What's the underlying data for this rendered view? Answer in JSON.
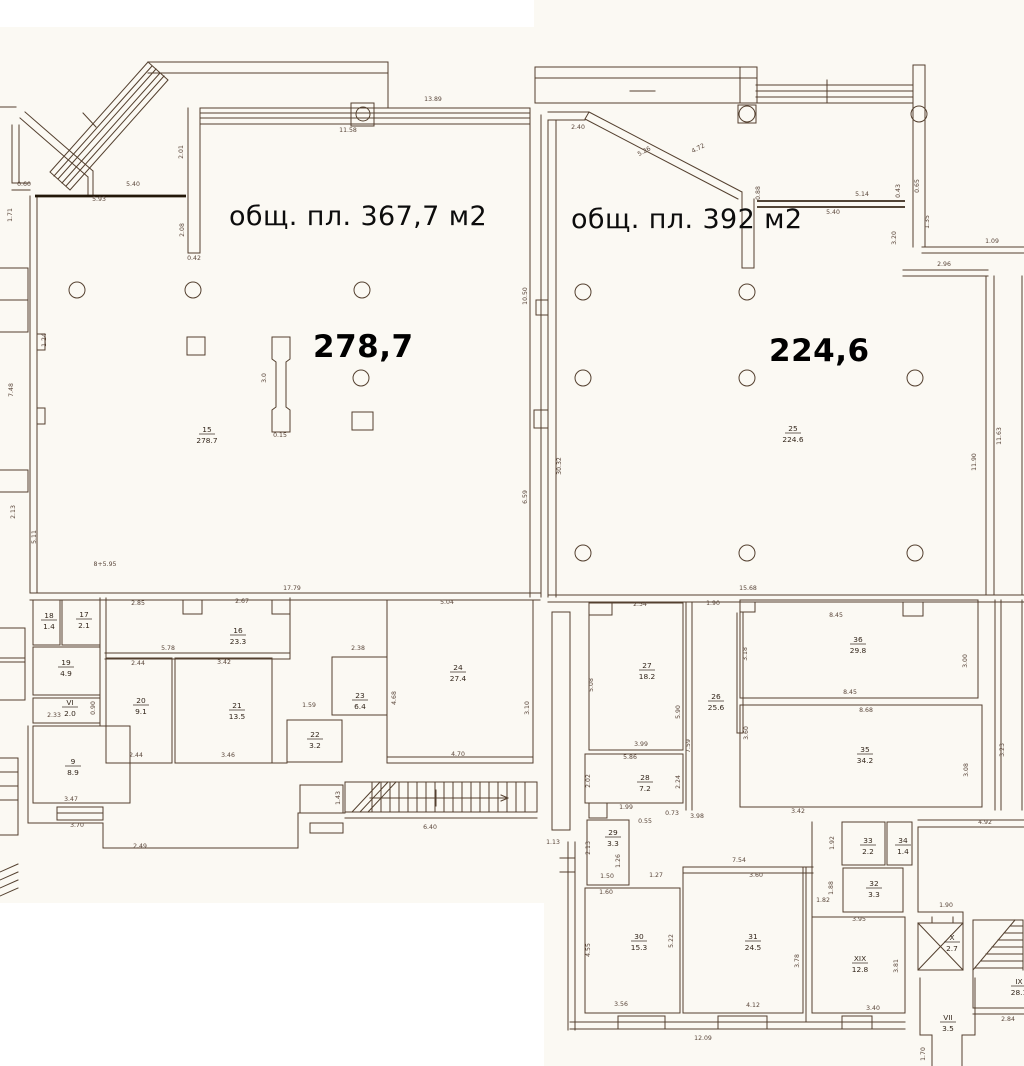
{
  "units": {
    "left": {
      "label": "общ. пл. 367,7 м2",
      "value": "278,7"
    },
    "right": {
      "label": "общ. пл. 392 м2",
      "value": "224,6"
    }
  },
  "colors": {
    "paper": "#fbf9f3",
    "ink": "#54402f",
    "label_ink": "#33261b",
    "dim_ink": "#5a463a",
    "text": "#0c0c0c"
  },
  "rooms": [
    {
      "n": "15",
      "a": "278.7",
      "x": 207,
      "y": 434
    },
    {
      "n": "25",
      "a": "224.6",
      "x": 793,
      "y": 433
    },
    {
      "n": "18",
      "a": "1.4",
      "x": 49,
      "y": 620
    },
    {
      "n": "17",
      "a": "2.1",
      "x": 84,
      "y": 619
    },
    {
      "n": "16",
      "a": "23.3",
      "x": 238,
      "y": 635
    },
    {
      "n": "19",
      "a": "4.9",
      "x": 66,
      "y": 667
    },
    {
      "n": "VI",
      "a": "2.0",
      "x": 70,
      "y": 707
    },
    {
      "n": "9",
      "a": "8.9",
      "x": 73,
      "y": 766
    },
    {
      "n": "20",
      "a": "9.1",
      "x": 141,
      "y": 705
    },
    {
      "n": "21",
      "a": "13.5",
      "x": 237,
      "y": 710
    },
    {
      "n": "22",
      "a": "3.2",
      "x": 315,
      "y": 739
    },
    {
      "n": "23",
      "a": "6.4",
      "x": 360,
      "y": 700
    },
    {
      "n": "24",
      "a": "27.4",
      "x": 458,
      "y": 672
    },
    {
      "n": "27",
      "a": "18.2",
      "x": 647,
      "y": 670
    },
    {
      "n": "26",
      "a": "25.6",
      "x": 716,
      "y": 701
    },
    {
      "n": "28",
      "a": "7.2",
      "x": 645,
      "y": 782
    },
    {
      "n": "36",
      "a": "29.8",
      "x": 858,
      "y": 644
    },
    {
      "n": "35",
      "a": "34.2",
      "x": 865,
      "y": 754
    },
    {
      "n": "29",
      "a": "3.3",
      "x": 613,
      "y": 837
    },
    {
      "n": "30",
      "a": "15.3",
      "x": 639,
      "y": 941
    },
    {
      "n": "31",
      "a": "24.5",
      "x": 753,
      "y": 941
    },
    {
      "n": "33",
      "a": "2.2",
      "x": 868,
      "y": 845
    },
    {
      "n": "34",
      "a": "1.4",
      "x": 903,
      "y": 845
    },
    {
      "n": "32",
      "a": "3.3",
      "x": 874,
      "y": 888
    },
    {
      "n": "XIX",
      "a": "12.8",
      "x": 860,
      "y": 963
    },
    {
      "n": "X",
      "a": "2.7",
      "x": 952,
      "y": 942
    },
    {
      "n": "VII",
      "a": "3.5",
      "x": 948,
      "y": 1022
    },
    {
      "n": "IX",
      "a": "28.1",
      "x": 1019,
      "y": 986
    }
  ],
  "dimensions": [
    {
      "t": "5.40",
      "x": 133,
      "y": 186
    },
    {
      "t": "5.93",
      "x": 99,
      "y": 201
    },
    {
      "t": "0.60",
      "x": 24,
      "y": 186
    },
    {
      "t": "1.71",
      "x": 12,
      "y": 215,
      "r": -90
    },
    {
      "t": "2.01",
      "x": 183,
      "y": 152,
      "r": -90
    },
    {
      "t": "2.08",
      "x": 184,
      "y": 230,
      "r": -90
    },
    {
      "t": "0.42",
      "x": 194,
      "y": 260
    },
    {
      "t": "11.58",
      "x": 348,
      "y": 132
    },
    {
      "t": "13.89",
      "x": 433,
      "y": 101
    },
    {
      "t": "7.48",
      "x": 13,
      "y": 390,
      "r": -90
    },
    {
      "t": "1.24",
      "x": 46,
      "y": 340,
      "r": -90
    },
    {
      "t": "2.13",
      "x": 15,
      "y": 512,
      "r": -90
    },
    {
      "t": "5.11",
      "x": 36,
      "y": 537,
      "r": -90
    },
    {
      "t": "8+5.95",
      "x": 105,
      "y": 566
    },
    {
      "t": "17.79",
      "x": 292,
      "y": 590
    },
    {
      "t": "3.0",
      "x": 266,
      "y": 378,
      "r": -90
    },
    {
      "t": "0.15",
      "x": 280,
      "y": 437
    },
    {
      "t": "6.59",
      "x": 527,
      "y": 497,
      "r": -90
    },
    {
      "t": "10.50",
      "x": 527,
      "y": 296,
      "r": -90
    },
    {
      "t": "30.32",
      "x": 561,
      "y": 466,
      "r": -90
    },
    {
      "t": "2.40",
      "x": 578,
      "y": 129
    },
    {
      "t": "5.26",
      "x": 645,
      "y": 153,
      "r": -28
    },
    {
      "t": "4.72",
      "x": 699,
      "y": 150,
      "r": -28
    },
    {
      "t": "0.88",
      "x": 760,
      "y": 193,
      "r": -90
    },
    {
      "t": "0.43",
      "x": 900,
      "y": 191,
      "r": -90
    },
    {
      "t": "0.65",
      "x": 919,
      "y": 186,
      "r": -90
    },
    {
      "t": "5.14",
      "x": 862,
      "y": 196
    },
    {
      "t": "5.40",
      "x": 833,
      "y": 214
    },
    {
      "t": "1.35",
      "x": 929,
      "y": 222,
      "r": -90
    },
    {
      "t": "3.20",
      "x": 896,
      "y": 238,
      "r": -90
    },
    {
      "t": "1.09",
      "x": 992,
      "y": 243
    },
    {
      "t": "2.96",
      "x": 944,
      "y": 266
    },
    {
      "t": "11.63",
      "x": 1001,
      "y": 436,
      "r": -90
    },
    {
      "t": "11.90",
      "x": 976,
      "y": 462,
      "r": -90
    },
    {
      "t": "15.68",
      "x": 748,
      "y": 590
    },
    {
      "t": "2.85",
      "x": 138,
      "y": 605
    },
    {
      "t": "2.67",
      "x": 242,
      "y": 603
    },
    {
      "t": "5.78",
      "x": 168,
      "y": 650
    },
    {
      "t": "2.44",
      "x": 138,
      "y": 665
    },
    {
      "t": "3.42",
      "x": 224,
      "y": 664
    },
    {
      "t": "2.44",
      "x": 136,
      "y": 757
    },
    {
      "t": "3.46",
      "x": 228,
      "y": 757
    },
    {
      "t": "2.33",
      "x": 54,
      "y": 717
    },
    {
      "t": "0.90",
      "x": 95,
      "y": 708,
      "r": -90
    },
    {
      "t": "1.59",
      "x": 309,
      "y": 707
    },
    {
      "t": "2.38",
      "x": 358,
      "y": 650
    },
    {
      "t": "5.04",
      "x": 447,
      "y": 604
    },
    {
      "t": "4.70",
      "x": 458,
      "y": 756
    },
    {
      "t": "4.68",
      "x": 396,
      "y": 698,
      "r": -90
    },
    {
      "t": "3.10",
      "x": 529,
      "y": 708,
      "r": -90
    },
    {
      "t": "3.47",
      "x": 71,
      "y": 801
    },
    {
      "t": "3.70",
      "x": 77,
      "y": 827
    },
    {
      "t": "2.49",
      "x": 140,
      "y": 848
    },
    {
      "t": "1.43",
      "x": 340,
      "y": 798,
      "r": -90
    },
    {
      "t": "6.40",
      "x": 430,
      "y": 829
    },
    {
      "t": "1.13",
      "x": 553,
      "y": 844
    },
    {
      "t": "2.54",
      "x": 640,
      "y": 606
    },
    {
      "t": "1.90",
      "x": 713,
      "y": 605
    },
    {
      "t": "3.99",
      "x": 641,
      "y": 746
    },
    {
      "t": "5.86",
      "x": 630,
      "y": 759
    },
    {
      "t": "1.99",
      "x": 626,
      "y": 809
    },
    {
      "t": "0.73",
      "x": 672,
      "y": 815
    },
    {
      "t": "0.55",
      "x": 645,
      "y": 823
    },
    {
      "t": "3.98",
      "x": 697,
      "y": 818
    },
    {
      "t": "2.02",
      "x": 590,
      "y": 781,
      "r": -90
    },
    {
      "t": "2.24",
      "x": 680,
      "y": 782,
      "r": -90
    },
    {
      "t": "5.08",
      "x": 593,
      "y": 685,
      "r": -90
    },
    {
      "t": "5.90",
      "x": 680,
      "y": 712,
      "r": -90
    },
    {
      "t": "7.59",
      "x": 690,
      "y": 746,
      "r": -90
    },
    {
      "t": "3.18",
      "x": 747,
      "y": 654,
      "r": -90
    },
    {
      "t": "3.60",
      "x": 748,
      "y": 733,
      "r": -90
    },
    {
      "t": "8.45",
      "x": 836,
      "y": 617
    },
    {
      "t": "8.45",
      "x": 850,
      "y": 694
    },
    {
      "t": "8.68",
      "x": 866,
      "y": 712
    },
    {
      "t": "3.42",
      "x": 798,
      "y": 813
    },
    {
      "t": "3.00",
      "x": 967,
      "y": 661,
      "r": -90
    },
    {
      "t": "3.08",
      "x": 968,
      "y": 770,
      "r": -90
    },
    {
      "t": "3.23",
      "x": 1004,
      "y": 750,
      "r": -90
    },
    {
      "t": "7.54",
      "x": 739,
      "y": 862
    },
    {
      "t": "3.60",
      "x": 756,
      "y": 877
    },
    {
      "t": "1.50",
      "x": 607,
      "y": 878
    },
    {
      "t": "1.27",
      "x": 656,
      "y": 877
    },
    {
      "t": "1.60",
      "x": 606,
      "y": 894
    },
    {
      "t": "2.13",
      "x": 590,
      "y": 848,
      "r": -90
    },
    {
      "t": "1.26",
      "x": 620,
      "y": 861,
      "r": -90
    },
    {
      "t": "3.56",
      "x": 621,
      "y": 1006
    },
    {
      "t": "4.12",
      "x": 753,
      "y": 1007
    },
    {
      "t": "12.09",
      "x": 703,
      "y": 1040
    },
    {
      "t": "4.55",
      "x": 590,
      "y": 950,
      "r": -90
    },
    {
      "t": "5.22",
      "x": 673,
      "y": 941,
      "r": -90
    },
    {
      "t": "3.78",
      "x": 799,
      "y": 961,
      "r": -90
    },
    {
      "t": "3.95",
      "x": 859,
      "y": 921
    },
    {
      "t": "3.40",
      "x": 873,
      "y": 1010
    },
    {
      "t": "3.81",
      "x": 898,
      "y": 966,
      "r": -90
    },
    {
      "t": "1.90",
      "x": 946,
      "y": 907
    },
    {
      "t": "4.92",
      "x": 985,
      "y": 824
    },
    {
      "t": "2.84",
      "x": 1008,
      "y": 1021
    },
    {
      "t": "1.70",
      "x": 925,
      "y": 1054,
      "r": -90
    },
    {
      "t": "1.92",
      "x": 834,
      "y": 843,
      "r": -90
    },
    {
      "t": "1.88",
      "x": 833,
      "y": 888,
      "r": -90
    },
    {
      "t": "1.82",
      "x": 823,
      "y": 902
    }
  ]
}
